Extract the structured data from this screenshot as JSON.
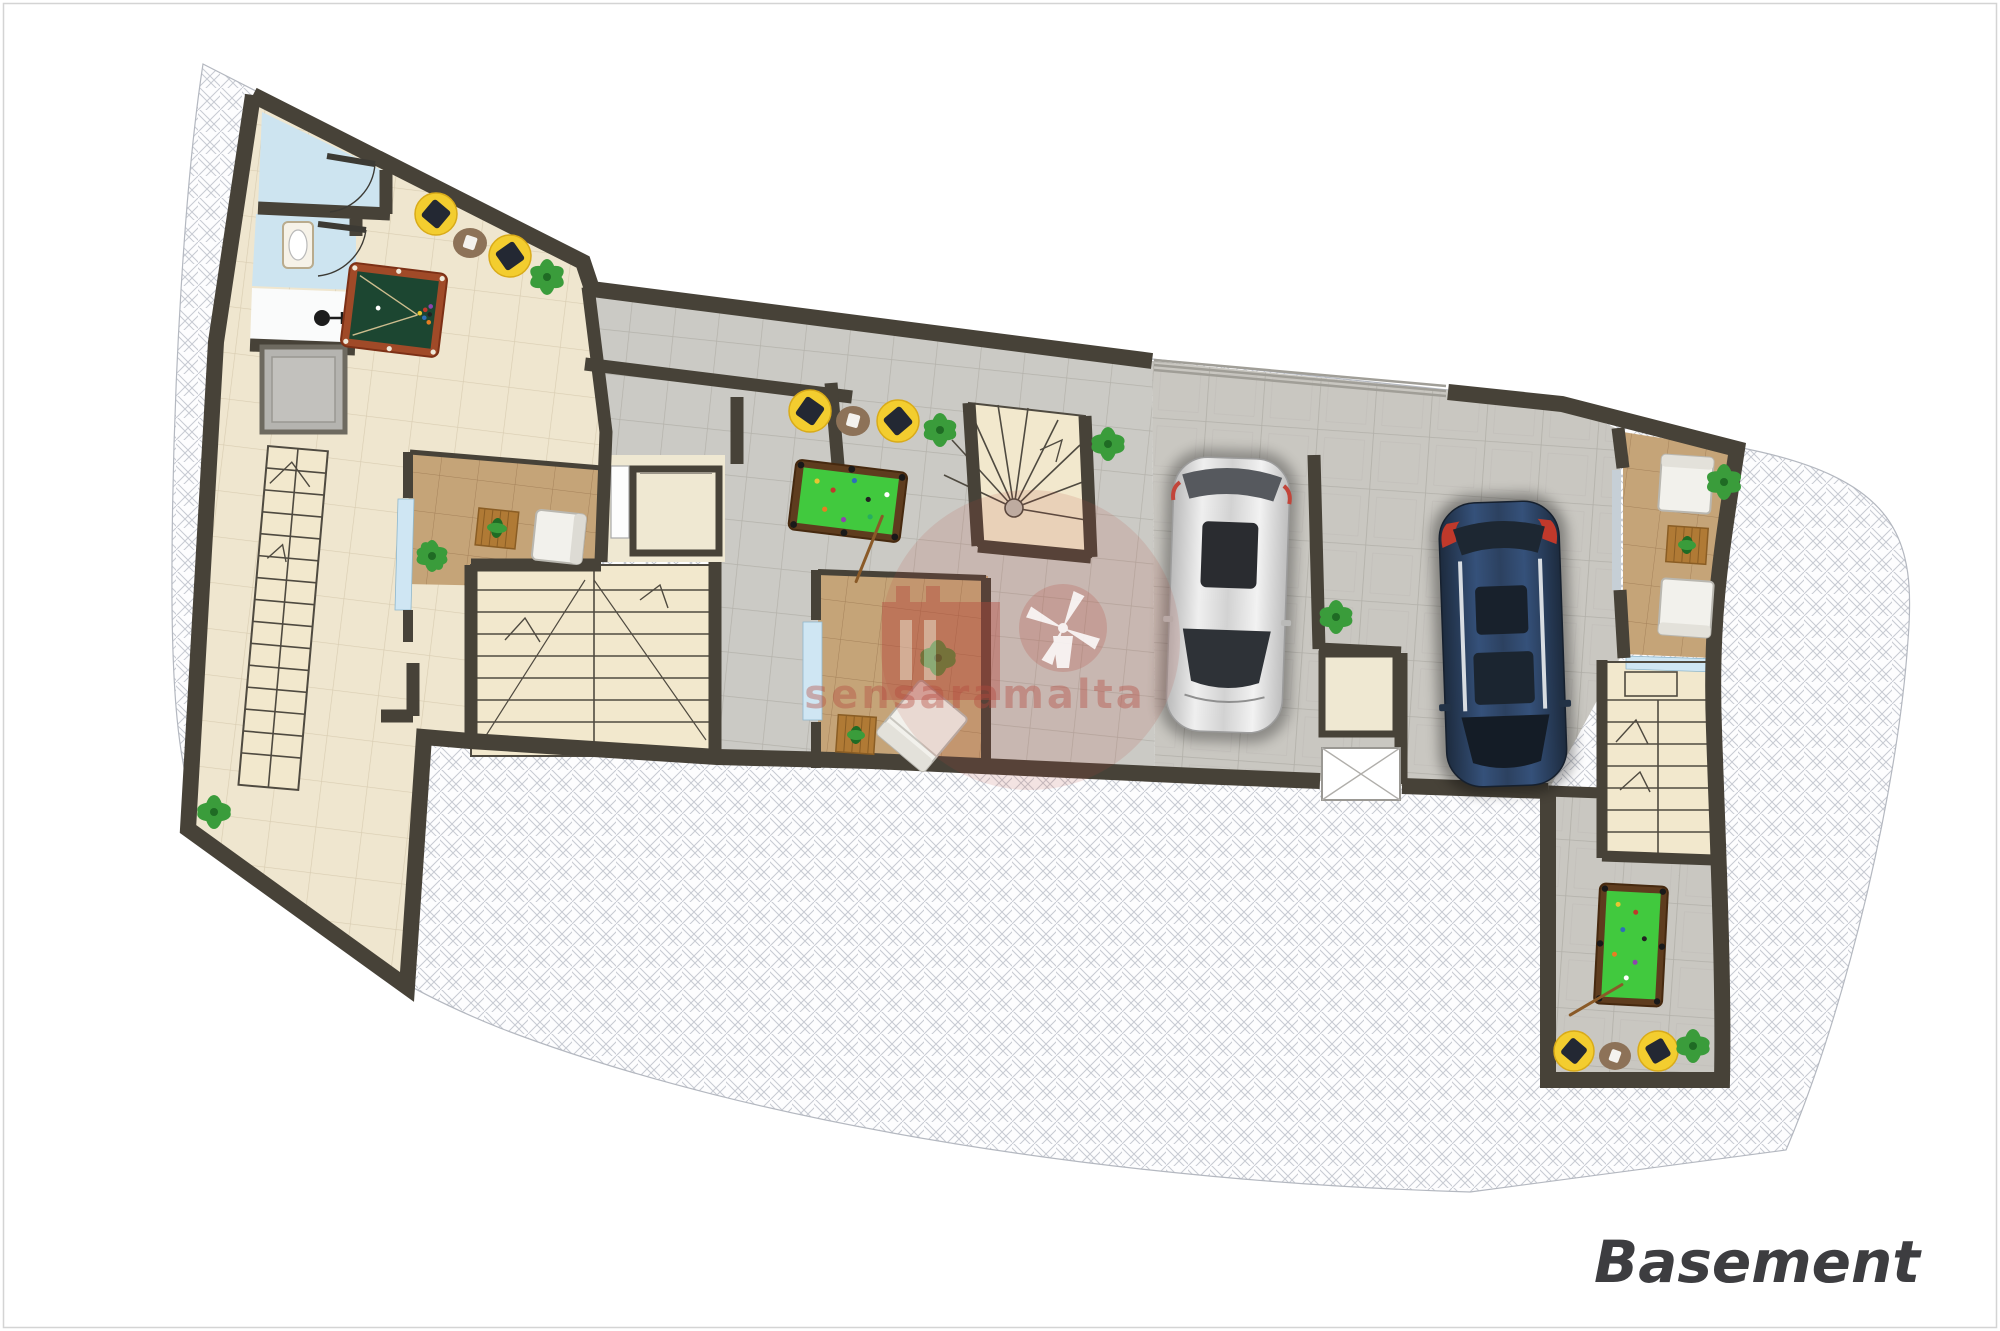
{
  "page": {
    "title": "Basement",
    "watermark_text": "sensaramalta"
  },
  "palette": {
    "wall": "#474238",
    "wall_light": "#6e6a60",
    "floor_cream": "#efe6cf",
    "floor_cream_line": "#d9cdb2",
    "floor_gray": "#cbcac5",
    "floor_gray_line": "#b4b2ab",
    "floor_stone": "#c9c7c1",
    "floor_stone_line": "#b2b0a9",
    "floor_terracotta": "#c5a478",
    "floor_terracotta_line": "#a5825a",
    "stairs_cream": "#f2e8cd",
    "stair_line": "#4f4a40",
    "elevator_cream": "#efe8d2",
    "window_blue": "#cfe6f3",
    "bathroom_blue": "#cde4f0",
    "shower_white": "#fafbfb",
    "shaft_gray": "#b5b4b0",
    "hatch_line": "#c7cad2",
    "site_line": "#b4b8c0",
    "page_border": "#d4d4d4",
    "pool_table_dark_felt": "#1c4631",
    "pool_table_dark_frame": "#a04a28",
    "pool_table_green_felt": "#41c93e",
    "pool_table_green_frame": "#5e3c1e",
    "beanbag_yellow": "#f3cd2f",
    "beanbag_pillow": "#232833",
    "rug_brown": "#8d7258",
    "plant_green": "#3a9c3b",
    "plant_green_dark": "#1f6b24",
    "wood_table": "#b07a35",
    "sofa_white": "#f2f1ec",
    "car_silver": "#d9d9d9",
    "car_blue": "#2c3f58",
    "car_glass": "#2e3237",
    "accent_red": "#c0392b",
    "garage_door_line": "#a09e97",
    "label_color": "#3d3d40",
    "watermark_red": "#b5473c"
  },
  "icons": [
    "pool-table-icon",
    "billiard-balls-icon",
    "cue-stick-icon",
    "beanbag-icon",
    "round-rug-icon",
    "potted-plant-icon",
    "sofa-icon",
    "armchair-icon",
    "chaise-icon",
    "coffee-table-icon",
    "elevator-icon",
    "shaft-icon",
    "staircase-icon",
    "spiral-staircase-icon",
    "u-staircase-icon",
    "car-top-view-icon",
    "sink-icon",
    "shower-icon",
    "door-swing-icon",
    "window-icon",
    "garage-door-icon",
    "light-well-icon",
    "windmill-watermark-icon"
  ]
}
